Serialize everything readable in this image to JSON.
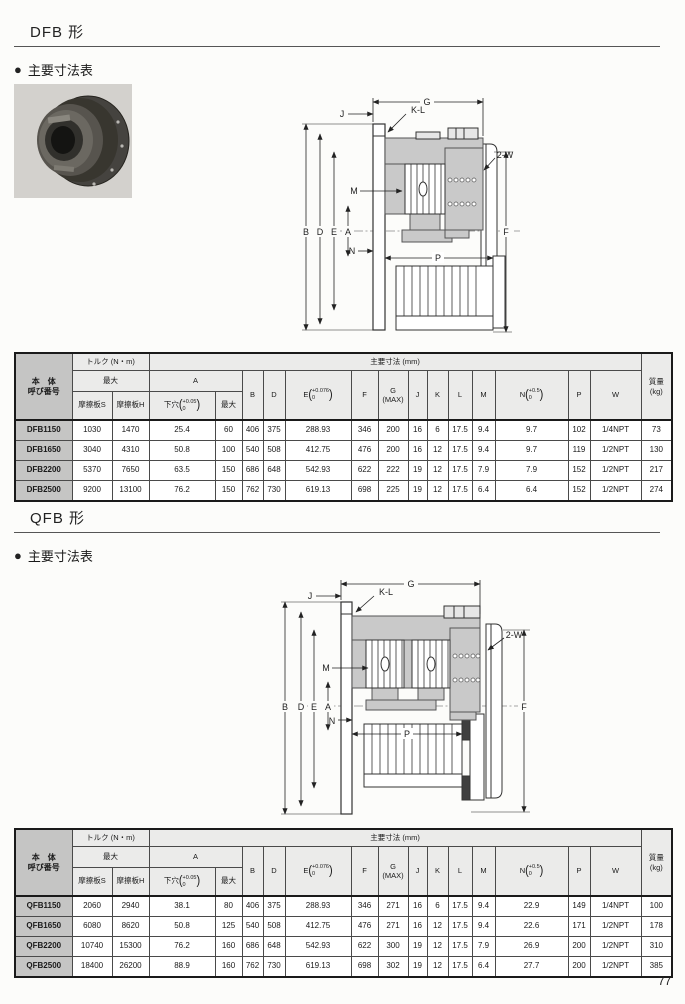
{
  "page": {
    "number": "77"
  },
  "table_header": {
    "body_line1": "本　体",
    "body_line2": "呼び番号",
    "torque_group": "トルク (N・m)",
    "max": "最大",
    "friction_s": "摩擦板S",
    "friction_h": "摩擦板H",
    "dims_group": "主要寸法 (mm)",
    "a": "A",
    "pilot": "下穴",
    "pilot_tol_top": "+0.05",
    "pilot_tol_bot": "0",
    "a_max": "最大",
    "b": "B",
    "d": "D",
    "e": "E",
    "e_tol_top": "+0.076",
    "e_tol_bot": "0",
    "f": "F",
    "g": "G",
    "g_sub": "(MAX)",
    "j": "J",
    "k": "K",
    "l": "L",
    "m": "M",
    "n": "N",
    "n_tol_top": "+0.5",
    "n_tol_bot": "0",
    "p": "P",
    "w": "W",
    "mass_line1": "質量",
    "mass_line2": "(kg)",
    "paren_open": "(",
    "paren_close": ")"
  },
  "sections": [
    {
      "title": "DFB 形",
      "bullet": "●",
      "subtitle": "主要寸法表",
      "drawing": {
        "labels": {
          "g": "G",
          "j": "J",
          "kl": "K-L",
          "w2": "2-W",
          "m": "M",
          "b": "B",
          "d": "D",
          "e": "E",
          "a": "A",
          "n": "N",
          "p": "P",
          "f": "F"
        }
      },
      "rows": [
        [
          "DFB1150",
          "1030",
          "1470",
          "25.4",
          "60",
          "406",
          "375",
          "288.93",
          "346",
          "200",
          "16",
          "6",
          "17.5",
          "9.4",
          "9.7",
          "102",
          "1/4NPT",
          "73"
        ],
        [
          "DFB1650",
          "3040",
          "4310",
          "50.8",
          "100",
          "540",
          "508",
          "412.75",
          "476",
          "200",
          "16",
          "12",
          "17.5",
          "9.4",
          "9.7",
          "119",
          "1/2NPT",
          "130"
        ],
        [
          "DFB2200",
          "5370",
          "7650",
          "63.5",
          "150",
          "686",
          "648",
          "542.93",
          "622",
          "222",
          "19",
          "12",
          "17.5",
          "7.9",
          "7.9",
          "152",
          "1/2NPT",
          "217"
        ],
        [
          "DFB2500",
          "9200",
          "13100",
          "76.2",
          "150",
          "762",
          "730",
          "619.13",
          "698",
          "225",
          "19",
          "12",
          "17.5",
          "6.4",
          "6.4",
          "152",
          "1/2NPT",
          "274"
        ]
      ]
    },
    {
      "title": "QFB 形",
      "bullet": "●",
      "subtitle": "主要寸法表",
      "drawing": {
        "labels": {
          "g": "G",
          "j": "J",
          "kl": "K-L",
          "w2": "2-W",
          "m": "M",
          "b": "B",
          "d": "D",
          "e": "E",
          "a": "A",
          "n": "N",
          "p": "P",
          "f": "F"
        }
      },
      "rows": [
        [
          "QFB1150",
          "2060",
          "2940",
          "38.1",
          "80",
          "406",
          "375",
          "288.93",
          "346",
          "271",
          "16",
          "6",
          "17.5",
          "9.4",
          "22.9",
          "149",
          "1/4NPT",
          "100"
        ],
        [
          "QFB1650",
          "6080",
          "8620",
          "50.8",
          "125",
          "540",
          "508",
          "412.75",
          "476",
          "271",
          "16",
          "12",
          "17.5",
          "9.4",
          "22.6",
          "171",
          "1/2NPT",
          "178"
        ],
        [
          "QFB2200",
          "10740",
          "15300",
          "76.2",
          "160",
          "686",
          "648",
          "542.93",
          "622",
          "300",
          "19",
          "12",
          "17.5",
          "7.9",
          "26.9",
          "200",
          "1/2NPT",
          "310"
        ],
        [
          "QFB2500",
          "18400",
          "26200",
          "88.9",
          "160",
          "762",
          "730",
          "619.13",
          "698",
          "302",
          "19",
          "12",
          "17.5",
          "6.4",
          "27.7",
          "200",
          "1/2NPT",
          "385"
        ]
      ]
    }
  ]
}
